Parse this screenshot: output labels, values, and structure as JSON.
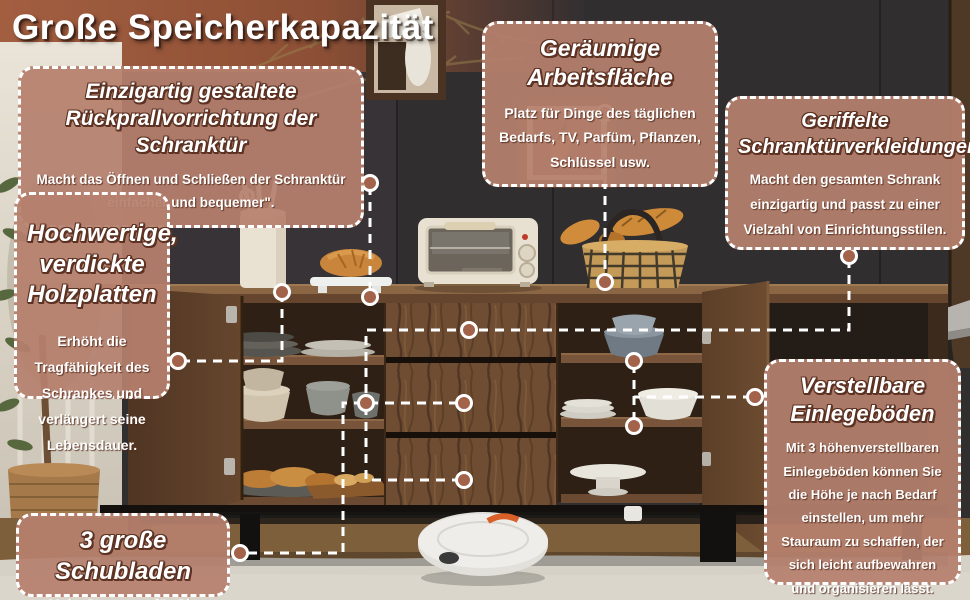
{
  "page_title": "Große Speicherkapazität",
  "callouts": {
    "door_rebound": {
      "title": "Einzigartig gestaltete Rückprallvorrichtung der Schranktür",
      "body": "Macht das Öffnen und Schließen der Schranktür einfacher und bequemer\"."
    },
    "wood_panels": {
      "title": "Hochwertige, verdickte Holzplatten",
      "body": "Erhöht die Tragfähigkeit des Schrankes und verlängert seine Lebensdauer."
    },
    "drawers": {
      "title": "3 große Schubladen",
      "body": "Mehr Stauraum für Sie"
    },
    "worktop": {
      "title": "Geräumige Arbeitsfläche",
      "body": "Platz für Dinge des täglichen Bedarfs, TV, Parfüm, Pflanzen, Schlüssel usw."
    },
    "fluted_doors": {
      "title": "Geriffelte Schranktürverkleidungen",
      "body": "Macht den gesamten Schrank einzigartig und passt zu einer Vielzahl von Einrichtungsstilen."
    },
    "adjustable_shelves": {
      "title": "Verstellbare Einlegeböden",
      "body": "Mit 3 höhenverstellbaren Einlegeböden können Sie die Höhe je nach Bedarf einstellen, um mehr Stauraum zu schaffen, der sich leicht aufbewahren und organisieren lässt."
    }
  },
  "colors": {
    "callout_bg": "#b6806e",
    "callout_border": "#ffffff",
    "title_outline": "#5d3222",
    "wall": "#312e30",
    "walnut_wood": "#6f4d33",
    "connector_line": "#ffffff",
    "connector_dot": "#a2634a"
  }
}
